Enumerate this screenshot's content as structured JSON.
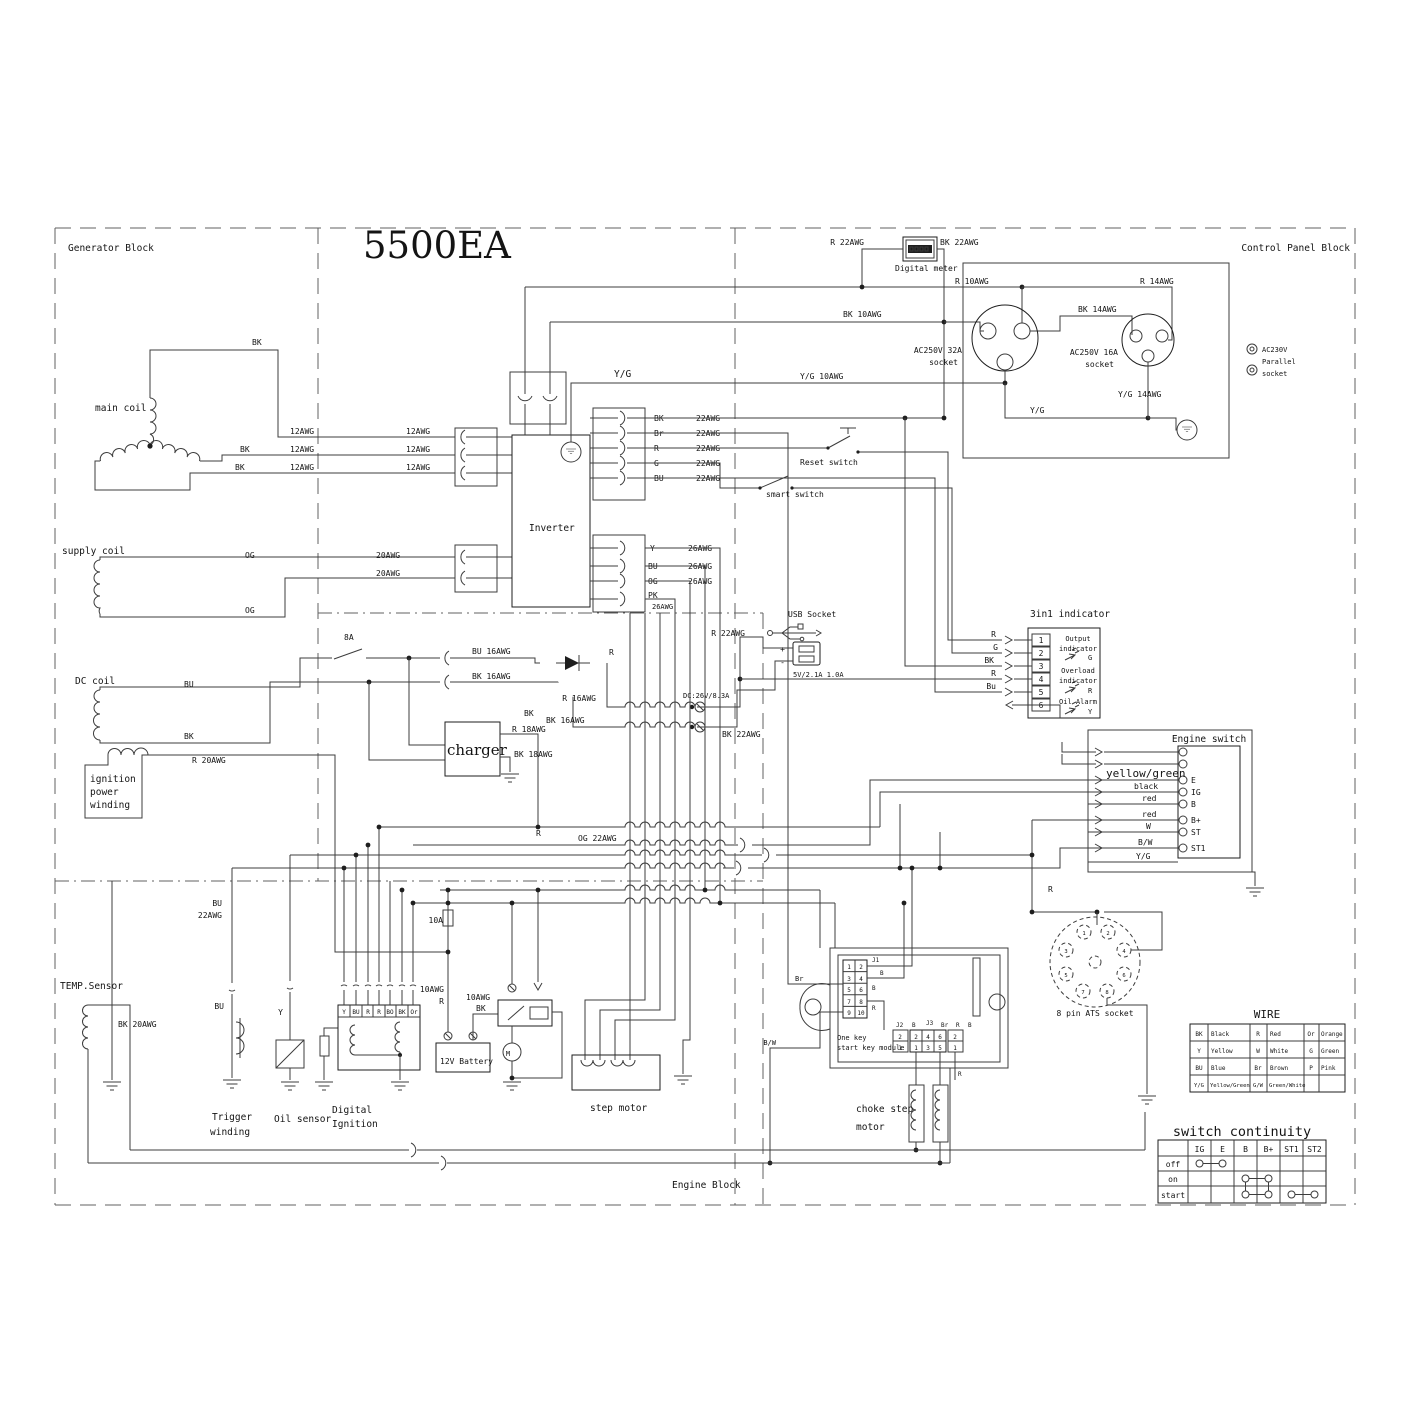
{
  "title": "5500EA",
  "c": {
    "generator": "Generator Block",
    "control": "Control Panel Block",
    "engine": "Engine Block",
    "main": "main coil",
    "supply": "supply coil",
    "dc": "DC coil",
    "ign1": "ignition",
    "ign2": "power",
    "ign3": "winding",
    "temp": "TEMP.Sensor",
    "trig1": "Trigger",
    "trig2": "winding",
    "oil": "Oil sensor",
    "digi1": "Digital",
    "digi2": "Ignition",
    "inverter": "Inverter",
    "charger": "charger",
    "meter": "Digital meter",
    "s32a": "AC250V 32A",
    "s32b": "socket",
    "s16a": "AC250V 16A",
    "s16b": "socket",
    "par1": "AC230V",
    "par2": "Parallel",
    "par3": "socket",
    "usb": "USB Socket",
    "usbspec": "5V/2.1A 1.0A",
    "plus": "+",
    "minus": "-",
    "dcout": "DC:26V/8.3A",
    "reset": "Reset switch",
    "smart": "smart switch",
    "batt": "12V Battery",
    "m": "M",
    "step": "step motor",
    "choke1": "choke step",
    "choke2": "motor",
    "onekey1": "One key",
    "onekey2": "start key module",
    "ats": "8 pin ATS socket",
    "engsw": "Engine switch"
  },
  "w": {
    "bk": "BK",
    "bu": "BU",
    "og": "OG",
    "pk": "PK",
    "y": "Y",
    "r": "R",
    "g": "G",
    "br": "Br",
    "or": "Or",
    "bo": "BO",
    "bw": "B/W",
    "yg": "Y/G",
    "wht": "W",
    "b": "B",
    "awg10": "10AWG",
    "awg12": "12AWG",
    "awg20": "20AWG",
    "awg22": "22AWG",
    "awg26": "26AWG",
    "r22": "R 22AWG",
    "bk22": "BK 22AWG",
    "r10": "R 10AWG",
    "bk10": "BK 10AWG",
    "r14": "R 14AWG",
    "bk14": "BK 14AWG",
    "yg10": "Y/G 10AWG",
    "yg14": "Y/G 14AWG",
    "bu16": "BU 16AWG",
    "bk16": "BK 16AWG",
    "r16": "R 16AWG",
    "r18": "R 18AWG",
    "bk18": "BK 18AWG",
    "r20": "R 20AWG",
    "bk20": "BK 20AWG",
    "og22": "OG 22AWG",
    "f8": "8A",
    "f10": "10A"
  },
  "ind": {
    "title": "3in1 indicator",
    "p": [
      "1",
      "2",
      "3",
      "4",
      "5",
      "6"
    ],
    "t1a": "Output",
    "t1b": "indicator",
    "g": "G",
    "t2a": "Overload",
    "t2b": "indicator",
    "r": "R",
    "t3": "Oil Alarm",
    "y": "Y",
    "in": [
      "R",
      "G",
      "BK",
      "R",
      "Bu"
    ]
  },
  "esw": {
    "terms": [
      "E",
      "IG",
      "B",
      "B+",
      "ST",
      "ST1"
    ],
    "wires": [
      "yellow/green",
      "black",
      "red",
      "red",
      "W",
      "B/W",
      "Y/G"
    ],
    "r": "R"
  },
  "mod": {
    "j1": "J1",
    "j2": "J2",
    "j3": "J3",
    "c10": [
      "1",
      "2",
      "3",
      "4",
      "5",
      "6",
      "7",
      "8",
      "9",
      "10"
    ],
    "t": [
      "2",
      "4",
      "6"
    ],
    "b": [
      "1",
      "3",
      "5"
    ],
    "p": [
      "2",
      "1"
    ],
    "b1": "B",
    "b2": "B",
    "r1": "R",
    "brl": "Br",
    "b3": "B",
    "r2": "R",
    "r3": "R",
    "bwl": "B/W"
  },
  "ignterms": [
    "Y",
    "BU",
    "R",
    "R",
    "BO",
    "BK",
    "Or"
  ],
  "atspins": [
    "1",
    "2",
    "3",
    "4",
    "5",
    "6",
    "7",
    "8"
  ],
  "wt": {
    "title": "WIRE",
    "rows": [
      [
        "BK",
        "Black",
        "R",
        "Red",
        "Or",
        "Orange"
      ],
      [
        "Y",
        "Yellow",
        "W",
        "White",
        "G",
        "Green"
      ],
      [
        "BU",
        "Blue",
        "Br",
        "Brown",
        "P",
        "Pink"
      ],
      [
        "Y/G",
        "Yellow/Green",
        "G/W",
        "Green/White",
        "",
        ""
      ]
    ]
  },
  "ct": {
    "title": "switch continuity",
    "cols": [
      "IG",
      "E",
      "B",
      "B+",
      "ST1",
      "ST2"
    ],
    "rows": [
      "off",
      "on",
      "start"
    ]
  }
}
